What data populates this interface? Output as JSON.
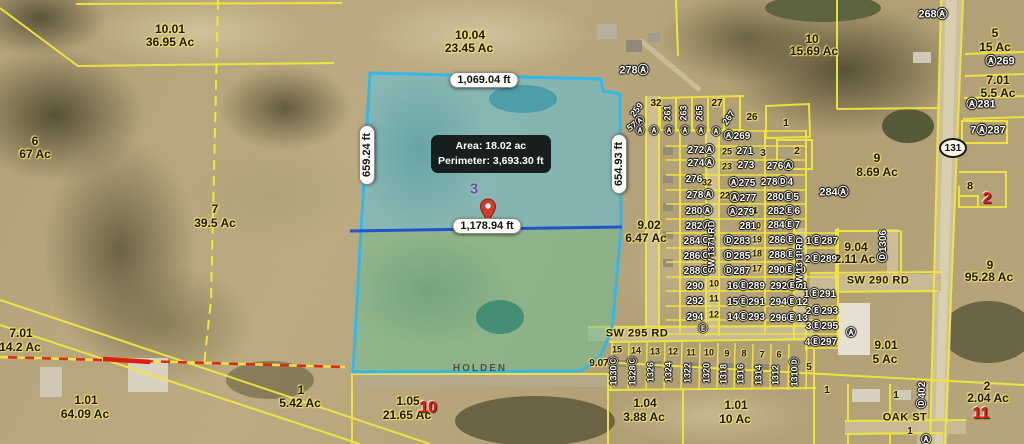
{
  "map": {
    "selected_parcel": {
      "number": "3",
      "info": {
        "area": "Area: 18.02 ac",
        "perimeter": "Perimeter: 3,693.30 ft"
      },
      "segments": [
        {
          "t": "1,069.04 ft",
          "x": 484,
          "y": 80,
          "r": 0
        },
        {
          "t": "659.24 ft",
          "x": 367,
          "y": 155,
          "r": -90
        },
        {
          "t": "654.93 ft",
          "x": 619,
          "y": 164,
          "r": -90
        },
        {
          "t": "1,178.94 ft",
          "x": 487,
          "y": 226,
          "r": 0
        }
      ]
    },
    "highway_shield": "131",
    "labels": [
      {
        "t": "10.01",
        "x": 170,
        "y": 29,
        "k": "p"
      },
      {
        "t": "36.95 Ac",
        "x": 170,
        "y": 42,
        "k": "p"
      },
      {
        "t": "10.04",
        "x": 470,
        "y": 35,
        "k": "p"
      },
      {
        "t": "23.45 Ac",
        "x": 469,
        "y": 48,
        "k": "p"
      },
      {
        "t": "6",
        "x": 35,
        "y": 141,
        "k": "p"
      },
      {
        "t": "67 Ac",
        "x": 35,
        "y": 154,
        "k": "p"
      },
      {
        "t": "7",
        "x": 215,
        "y": 209,
        "k": "p"
      },
      {
        "t": "39.5 Ac",
        "x": 215,
        "y": 223,
        "k": "p"
      },
      {
        "t": "10",
        "x": 812,
        "y": 39,
        "k": "p"
      },
      {
        "t": "15.69 Ac",
        "x": 814,
        "y": 51,
        "k": "p"
      },
      {
        "t": "5",
        "x": 995,
        "y": 33,
        "k": "p"
      },
      {
        "t": "15 Ac",
        "x": 995,
        "y": 47,
        "k": "p"
      },
      {
        "t": "7.01",
        "x": 998,
        "y": 80,
        "k": "p"
      },
      {
        "t": "5.5 Ac",
        "x": 998,
        "y": 93,
        "k": "p"
      },
      {
        "t": "9",
        "x": 877,
        "y": 158,
        "k": "p"
      },
      {
        "t": "8.69 Ac",
        "x": 877,
        "y": 172,
        "k": "p"
      },
      {
        "t": "8",
        "x": 970,
        "y": 187,
        "k": "p",
        "f": 11
      },
      {
        "t": "9.02",
        "x": 649,
        "y": 225,
        "k": "p"
      },
      {
        "t": "6.47 Ac",
        "x": 646,
        "y": 238,
        "k": "p"
      },
      {
        "t": "9.04",
        "x": 856,
        "y": 247,
        "k": "p"
      },
      {
        "t": "2.11 Ac",
        "x": 855,
        "y": 259,
        "k": "p"
      },
      {
        "t": "9",
        "x": 990,
        "y": 265,
        "k": "p"
      },
      {
        "t": "95.28 Ac",
        "x": 989,
        "y": 277,
        "k": "p"
      },
      {
        "t": "7.01",
        "x": 21,
        "y": 333,
        "k": "p"
      },
      {
        "t": "14.2 Ac",
        "x": 20,
        "y": 347,
        "k": "p"
      },
      {
        "t": "1.01",
        "x": 86,
        "y": 400,
        "k": "p"
      },
      {
        "t": "64.09 Ac",
        "x": 85,
        "y": 414,
        "k": "p"
      },
      {
        "t": "1",
        "x": 301,
        "y": 390,
        "k": "p"
      },
      {
        "t": "5.42 Ac",
        "x": 300,
        "y": 403,
        "k": "p"
      },
      {
        "t": "1.05",
        "x": 408,
        "y": 401,
        "k": "p"
      },
      {
        "t": "21.65 Ac",
        "x": 407,
        "y": 415,
        "k": "p"
      },
      {
        "t": "1.04",
        "x": 645,
        "y": 403,
        "k": "p"
      },
      {
        "t": "3.88 Ac",
        "x": 644,
        "y": 417,
        "k": "p"
      },
      {
        "t": "1.01",
        "x": 736,
        "y": 405,
        "k": "p"
      },
      {
        "t": "10 Ac",
        "x": 735,
        "y": 419,
        "k": "p"
      },
      {
        "t": "9.01",
        "x": 886,
        "y": 345,
        "k": "p"
      },
      {
        "t": "5 Ac",
        "x": 885,
        "y": 359,
        "k": "p"
      },
      {
        "t": "2",
        "x": 987,
        "y": 386,
        "k": "p"
      },
      {
        "t": "2.04 Ac",
        "x": 988,
        "y": 398,
        "k": "p"
      },
      {
        "t": "9.07",
        "x": 599,
        "y": 364,
        "k": "p",
        "f": 10
      },
      {
        "t": "5",
        "x": 809,
        "y": 368,
        "k": "p",
        "f": 10
      },
      {
        "t": "1",
        "x": 896,
        "y": 396,
        "k": "p",
        "f": 10
      },
      {
        "t": "1",
        "x": 827,
        "y": 391,
        "k": "p",
        "f": 10
      },
      {
        "t": "1",
        "x": 910,
        "y": 432,
        "k": "p",
        "f": 10
      },
      {
        "t": "1",
        "x": 786,
        "y": 124,
        "k": "p",
        "f": 10
      },
      {
        "t": "2",
        "x": 797,
        "y": 152,
        "k": "p",
        "f": 10
      },
      {
        "t": "3",
        "x": 763,
        "y": 154,
        "k": "p",
        "f": 10
      },
      {
        "t": "26",
        "x": 752,
        "y": 118,
        "k": "p",
        "f": 10
      },
      {
        "t": "27",
        "x": 717,
        "y": 104,
        "k": "p",
        "f": 10
      },
      {
        "t": "32",
        "x": 656,
        "y": 104,
        "k": "p",
        "f": 10
      },
      {
        "t": "32",
        "x": 707,
        "y": 183,
        "k": "p",
        "f": 9
      },
      {
        "t": "25",
        "x": 727,
        "y": 152,
        "k": "p",
        "f": 9
      },
      {
        "t": "23",
        "x": 727,
        "y": 167,
        "k": "p",
        "f": 9
      },
      {
        "t": "22",
        "x": 725,
        "y": 196,
        "k": "p",
        "f": 9
      },
      {
        "t": "21",
        "x": 753,
        "y": 211,
        "k": "p",
        "f": 9
      },
      {
        "t": "20",
        "x": 756,
        "y": 226,
        "k": "p",
        "f": 9
      },
      {
        "t": "19",
        "x": 757,
        "y": 240,
        "k": "p",
        "f": 9
      },
      {
        "t": "18",
        "x": 757,
        "y": 254,
        "k": "p",
        "f": 9
      },
      {
        "t": "17",
        "x": 757,
        "y": 269,
        "k": "p",
        "f": 9
      },
      {
        "t": "7",
        "x": 712,
        "y": 238,
        "k": "p",
        "f": 9
      },
      {
        "t": "8",
        "x": 712,
        "y": 254,
        "k": "p",
        "f": 9
      },
      {
        "t": "9",
        "x": 712,
        "y": 268,
        "k": "p",
        "f": 9
      },
      {
        "t": "10",
        "x": 714,
        "y": 284,
        "k": "p",
        "f": 9
      },
      {
        "t": "11",
        "x": 714,
        "y": 299,
        "k": "p",
        "f": 9
      },
      {
        "t": "12",
        "x": 714,
        "y": 315,
        "k": "p",
        "f": 9
      },
      {
        "t": "15",
        "x": 617,
        "y": 350,
        "k": "p",
        "f": 9
      },
      {
        "t": "14",
        "x": 636,
        "y": 351,
        "k": "p",
        "f": 9
      },
      {
        "t": "13",
        "x": 655,
        "y": 352,
        "k": "p",
        "f": 9
      },
      {
        "t": "12",
        "x": 673,
        "y": 352,
        "k": "p",
        "f": 9
      },
      {
        "t": "11",
        "x": 691,
        "y": 353,
        "k": "p",
        "f": 9
      },
      {
        "t": "10",
        "x": 709,
        "y": 353,
        "k": "p",
        "f": 9
      },
      {
        "t": "9",
        "x": 727,
        "y": 354,
        "k": "p",
        "f": 9
      },
      {
        "t": "8",
        "x": 744,
        "y": 354,
        "k": "p",
        "f": 9
      },
      {
        "t": "7",
        "x": 762,
        "y": 355,
        "k": "p",
        "f": 9
      },
      {
        "t": "6",
        "x": 779,
        "y": 355,
        "k": "p",
        "f": 9
      },
      {
        "t": "268Ⓐ",
        "x": 933,
        "y": 15,
        "k": "s",
        "f": 11
      },
      {
        "t": "278Ⓐ",
        "x": 634,
        "y": 71,
        "k": "s",
        "f": 11
      },
      {
        "t": "Ⓐ269",
        "x": 1000,
        "y": 62,
        "k": "s",
        "f": 11
      },
      {
        "t": "Ⓐ281",
        "x": 981,
        "y": 105,
        "k": "s",
        "f": 11
      },
      {
        "t": "7Ⓐ287",
        "x": 988,
        "y": 131,
        "k": "s",
        "f": 11
      },
      {
        "t": "284Ⓐ",
        "x": 834,
        "y": 193,
        "k": "s",
        "f": 11
      },
      {
        "t": "259",
        "x": 637,
        "y": 110,
        "k": "s",
        "r": -52
      },
      {
        "t": "57Ⓐ",
        "x": 636,
        "y": 124,
        "k": "s",
        "r": -35
      },
      {
        "t": "261",
        "x": 668,
        "y": 113,
        "k": "s",
        "r": -90
      },
      {
        "t": "263",
        "x": 684,
        "y": 113,
        "k": "s",
        "r": -90
      },
      {
        "t": "265",
        "x": 700,
        "y": 113,
        "k": "s",
        "r": -90
      },
      {
        "t": "267",
        "x": 729,
        "y": 118,
        "k": "s",
        "r": -55
      },
      {
        "t": "Ⓐ",
        "x": 640,
        "y": 131,
        "k": "s"
      },
      {
        "t": "Ⓐ",
        "x": 654,
        "y": 131,
        "k": "s"
      },
      {
        "t": "Ⓐ",
        "x": 669,
        "y": 131,
        "k": "s"
      },
      {
        "t": "Ⓐ",
        "x": 685,
        "y": 131,
        "k": "s"
      },
      {
        "t": "Ⓐ",
        "x": 701,
        "y": 131,
        "k": "s"
      },
      {
        "t": "Ⓐ",
        "x": 716,
        "y": 132,
        "k": "s"
      },
      {
        "t": "Ⓐ269",
        "x": 737,
        "y": 137,
        "k": "s",
        "f": 10
      },
      {
        "t": "272Ⓐ",
        "x": 701,
        "y": 151,
        "k": "s",
        "f": 10
      },
      {
        "t": "271",
        "x": 745,
        "y": 152,
        "k": "s",
        "f": 10
      },
      {
        "t": "274Ⓐ",
        "x": 701,
        "y": 164,
        "k": "s",
        "f": 10
      },
      {
        "t": "273",
        "x": 746,
        "y": 166,
        "k": "s",
        "f": 10
      },
      {
        "t": "276Ⓐ",
        "x": 780,
        "y": 167,
        "k": "s",
        "f": 10
      },
      {
        "t": "276",
        "x": 694,
        "y": 180,
        "k": "s",
        "f": 10
      },
      {
        "t": "Ⓐ275",
        "x": 742,
        "y": 184,
        "k": "s",
        "f": 10
      },
      {
        "t": "278Ⓓ4",
        "x": 777,
        "y": 183,
        "k": "s",
        "f": 10
      },
      {
        "t": "278Ⓐ",
        "x": 700,
        "y": 196,
        "k": "s",
        "f": 10
      },
      {
        "t": "Ⓐ277",
        "x": 743,
        "y": 199,
        "k": "s",
        "f": 10
      },
      {
        "t": "280Ⓔ5",
        "x": 783,
        "y": 198,
        "k": "s",
        "f": 10
      },
      {
        "t": "280Ⓐ",
        "x": 699,
        "y": 212,
        "k": "s",
        "f": 10
      },
      {
        "t": "Ⓐ279",
        "x": 741,
        "y": 213,
        "k": "s",
        "f": 10
      },
      {
        "t": "282Ⓔ6",
        "x": 784,
        "y": 212,
        "k": "s",
        "f": 10
      },
      {
        "t": "282Ⓐ",
        "x": 699,
        "y": 227,
        "k": "s",
        "f": 10
      },
      {
        "t": "281",
        "x": 748,
        "y": 227,
        "k": "s",
        "f": 10
      },
      {
        "t": "284Ⓔ7",
        "x": 784,
        "y": 226,
        "k": "s",
        "f": 10
      },
      {
        "t": "284Ⓒ",
        "x": 697,
        "y": 242,
        "k": "s",
        "f": 10
      },
      {
        "t": "Ⓓ283",
        "x": 737,
        "y": 242,
        "k": "s",
        "f": 10
      },
      {
        "t": "286Ⓔ8",
        "x": 785,
        "y": 241,
        "k": "s",
        "f": 10
      },
      {
        "t": "286Ⓒ",
        "x": 697,
        "y": 257,
        "k": "s",
        "f": 10
      },
      {
        "t": "Ⓓ285",
        "x": 737,
        "y": 257,
        "k": "s",
        "f": 10
      },
      {
        "t": "288Ⓔ9",
        "x": 785,
        "y": 256,
        "k": "s",
        "f": 10
      },
      {
        "t": "288Ⓒ",
        "x": 697,
        "y": 272,
        "k": "s",
        "f": 10
      },
      {
        "t": "Ⓓ287",
        "x": 737,
        "y": 272,
        "k": "s",
        "f": 10
      },
      {
        "t": "290Ⓔ10",
        "x": 787,
        "y": 271,
        "k": "s",
        "f": 10
      },
      {
        "t": "290",
        "x": 695,
        "y": 287,
        "k": "s",
        "f": 10
      },
      {
        "t": "16Ⓔ289",
        "x": 746,
        "y": 287,
        "k": "s",
        "f": 10
      },
      {
        "t": "292Ⓔ11",
        "x": 789,
        "y": 287,
        "k": "s",
        "f": 10
      },
      {
        "t": "292",
        "x": 695,
        "y": 302,
        "k": "s",
        "f": 10
      },
      {
        "t": "15Ⓔ291",
        "x": 746,
        "y": 303,
        "k": "s",
        "f": 10
      },
      {
        "t": "294Ⓔ12",
        "x": 789,
        "y": 303,
        "k": "s",
        "f": 10
      },
      {
        "t": "294",
        "x": 695,
        "y": 318,
        "k": "s",
        "f": 10
      },
      {
        "t": "14Ⓔ293",
        "x": 746,
        "y": 318,
        "k": "s",
        "f": 10
      },
      {
        "t": "296Ⓔ13",
        "x": 789,
        "y": 319,
        "k": "s",
        "f": 10
      },
      {
        "t": "Ⓔ",
        "x": 703,
        "y": 329,
        "k": "s"
      },
      {
        "t": "1Ⓔ287",
        "x": 822,
        "y": 242,
        "k": "s",
        "f": 10
      },
      {
        "t": "2Ⓔ289",
        "x": 821,
        "y": 260,
        "k": "s",
        "f": 10
      },
      {
        "t": "1Ⓔ291",
        "x": 820,
        "y": 295,
        "k": "s",
        "f": 10
      },
      {
        "t": "2Ⓔ293",
        "x": 822,
        "y": 312,
        "k": "s",
        "f": 10
      },
      {
        "t": "3Ⓔ295",
        "x": 822,
        "y": 327,
        "k": "s",
        "f": 10
      },
      {
        "t": "4Ⓔ297",
        "x": 821,
        "y": 343,
        "k": "s",
        "f": 10
      },
      {
        "t": "Ⓐ",
        "x": 851,
        "y": 334,
        "k": "s",
        "f": 10
      },
      {
        "t": "Ⓐ",
        "x": 926,
        "y": 441,
        "k": "s",
        "f": 10
      },
      {
        "t": "SW 1371 RD",
        "x": 712,
        "y": 247,
        "k": "s",
        "f": 9,
        "r": -90
      },
      {
        "t": "SW 1311 RD",
        "x": 800,
        "y": 263,
        "k": "s",
        "f": 9,
        "r": -90
      },
      {
        "t": "Ⓓ1306",
        "x": 884,
        "y": 246,
        "k": "s",
        "f": 10,
        "r": -90
      },
      {
        "t": "Ⓓ402",
        "x": 923,
        "y": 395,
        "k": "s",
        "f": 10,
        "r": -90
      },
      {
        "t": "1330Ⓒ",
        "x": 614,
        "y": 371,
        "k": "s",
        "r": -90
      },
      {
        "t": "1328Ⓒ",
        "x": 633,
        "y": 371,
        "k": "s",
        "r": -90
      },
      {
        "t": "1326",
        "x": 651,
        "y": 372,
        "k": "s",
        "r": -90
      },
      {
        "t": "1324",
        "x": 669,
        "y": 372,
        "k": "s",
        "r": -90
      },
      {
        "t": "1322",
        "x": 688,
        "y": 373,
        "k": "s",
        "r": -90
      },
      {
        "t": "1320",
        "x": 707,
        "y": 373,
        "k": "s",
        "r": -90
      },
      {
        "t": "1318",
        "x": 724,
        "y": 374,
        "k": "s",
        "r": -90
      },
      {
        "t": "1316",
        "x": 741,
        "y": 374,
        "k": "s",
        "r": -90
      },
      {
        "t": "1314",
        "x": 759,
        "y": 375,
        "k": "s",
        "r": -90
      },
      {
        "t": "1312",
        "x": 776,
        "y": 375,
        "k": "s",
        "r": -90
      },
      {
        "t": "1310Ⓓ",
        "x": 795,
        "y": 372,
        "k": "s",
        "r": -90
      },
      {
        "t": "10",
        "x": 428,
        "y": 408,
        "k": "r"
      },
      {
        "t": "2",
        "x": 987,
        "y": 199,
        "k": "r"
      },
      {
        "t": "11",
        "x": 981,
        "y": 414,
        "k": "r"
      },
      {
        "t": "SW 290 RD",
        "x": 878,
        "y": 281,
        "k": "rd"
      },
      {
        "t": "SW 295 RD",
        "x": 637,
        "y": 334,
        "k": "rd"
      },
      {
        "t": "OAK ST",
        "x": 905,
        "y": 418,
        "k": "rd"
      },
      {
        "t": "HOLDEN",
        "x": 480,
        "y": 369,
        "k": "hd"
      }
    ]
  }
}
